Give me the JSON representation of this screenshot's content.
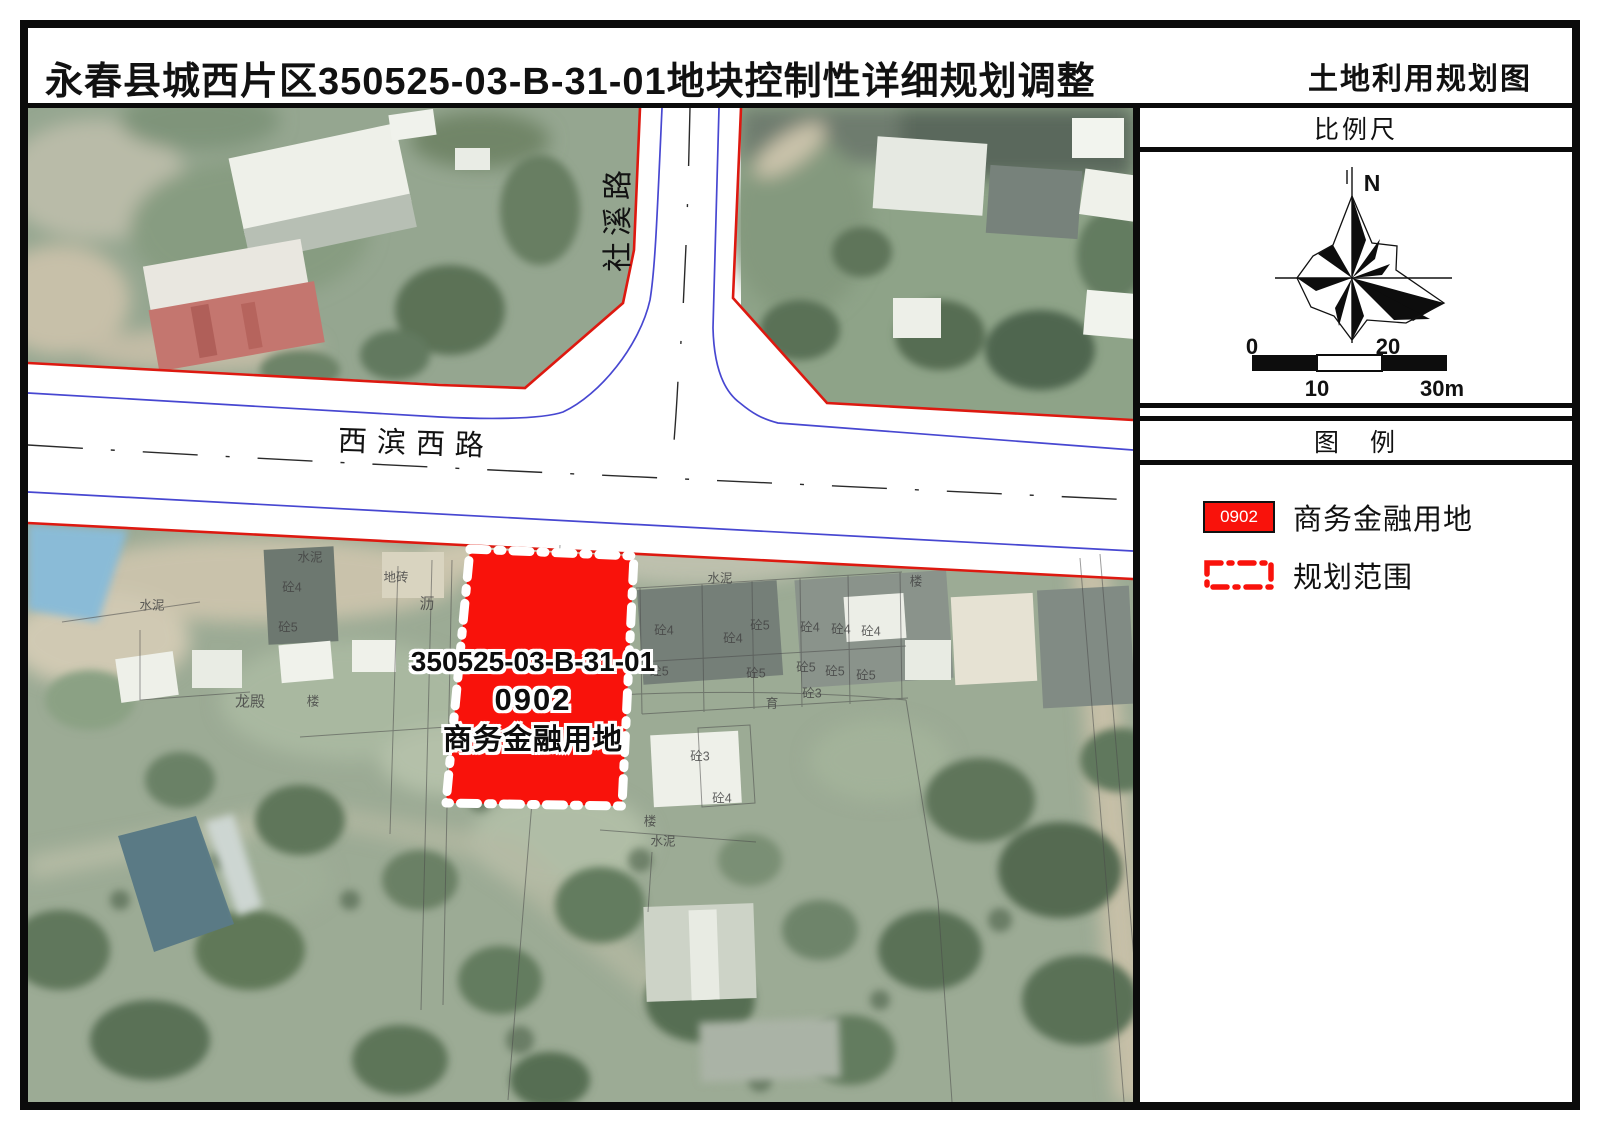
{
  "page": {
    "title_left": "永春县城西片区350525-03-B-31-01地块控制性详细规划调整",
    "title_right": "土地利用规划图"
  },
  "sidebar": {
    "scale": {
      "title": "比例尺",
      "north": "N",
      "tick0": "0",
      "tick10": "10",
      "tick20": "20",
      "tick30": "30m"
    },
    "legend": {
      "title": "图　例",
      "item_land": {
        "code": "0902",
        "label": "商务金融用地"
      },
      "item_boundary": {
        "label": "规划范围"
      }
    }
  },
  "map": {
    "road_labels": {
      "vertical": "社溪路",
      "horizontal": "西滨西路"
    },
    "plot": {
      "parcel": "350525-03-B-31-01",
      "code": "0902",
      "use": "商务金融用地"
    },
    "cadastral_labels": [
      {
        "t": "地砖",
        "x": 396,
        "y": 576
      },
      {
        "t": "水泥",
        "x": 152,
        "y": 604
      },
      {
        "t": "水泥",
        "x": 310,
        "y": 556
      },
      {
        "t": "砼4",
        "x": 292,
        "y": 586
      },
      {
        "t": "砼5",
        "x": 288,
        "y": 626
      },
      {
        "t": "楼",
        "x": 313,
        "y": 700
      },
      {
        "t": "龙殿",
        "x": 250,
        "y": 701,
        "s": 15
      },
      {
        "t": "沥",
        "x": 427,
        "y": 603,
        "s": 15
      },
      {
        "t": "水泥",
        "x": 720,
        "y": 577
      },
      {
        "t": "砼4",
        "x": 664,
        "y": 629
      },
      {
        "t": "砼4",
        "x": 733,
        "y": 637
      },
      {
        "t": "砼5",
        "x": 760,
        "y": 624
      },
      {
        "t": "砼4",
        "x": 810,
        "y": 626
      },
      {
        "t": "砼4",
        "x": 841,
        "y": 628
      },
      {
        "t": "砼4",
        "x": 871,
        "y": 630
      },
      {
        "t": "砼5",
        "x": 659,
        "y": 670
      },
      {
        "t": "砼5",
        "x": 756,
        "y": 672
      },
      {
        "t": "砼5",
        "x": 806,
        "y": 666
      },
      {
        "t": "砼5",
        "x": 835,
        "y": 670
      },
      {
        "t": "砼5",
        "x": 866,
        "y": 674
      },
      {
        "t": "砼3",
        "x": 812,
        "y": 692
      },
      {
        "t": "育",
        "x": 772,
        "y": 702
      },
      {
        "t": "砼3",
        "x": 700,
        "y": 755
      },
      {
        "t": "砼4",
        "x": 722,
        "y": 797
      },
      {
        "t": "楼",
        "x": 650,
        "y": 820
      },
      {
        "t": "水泥",
        "x": 663,
        "y": 840
      },
      {
        "t": "楼",
        "x": 916,
        "y": 580
      }
    ]
  },
  "colors": {
    "plot_red": "#f9120b",
    "legend_red": "#f9120b",
    "boundary_red": "#dd1910",
    "road_blue": "#4747d1"
  }
}
